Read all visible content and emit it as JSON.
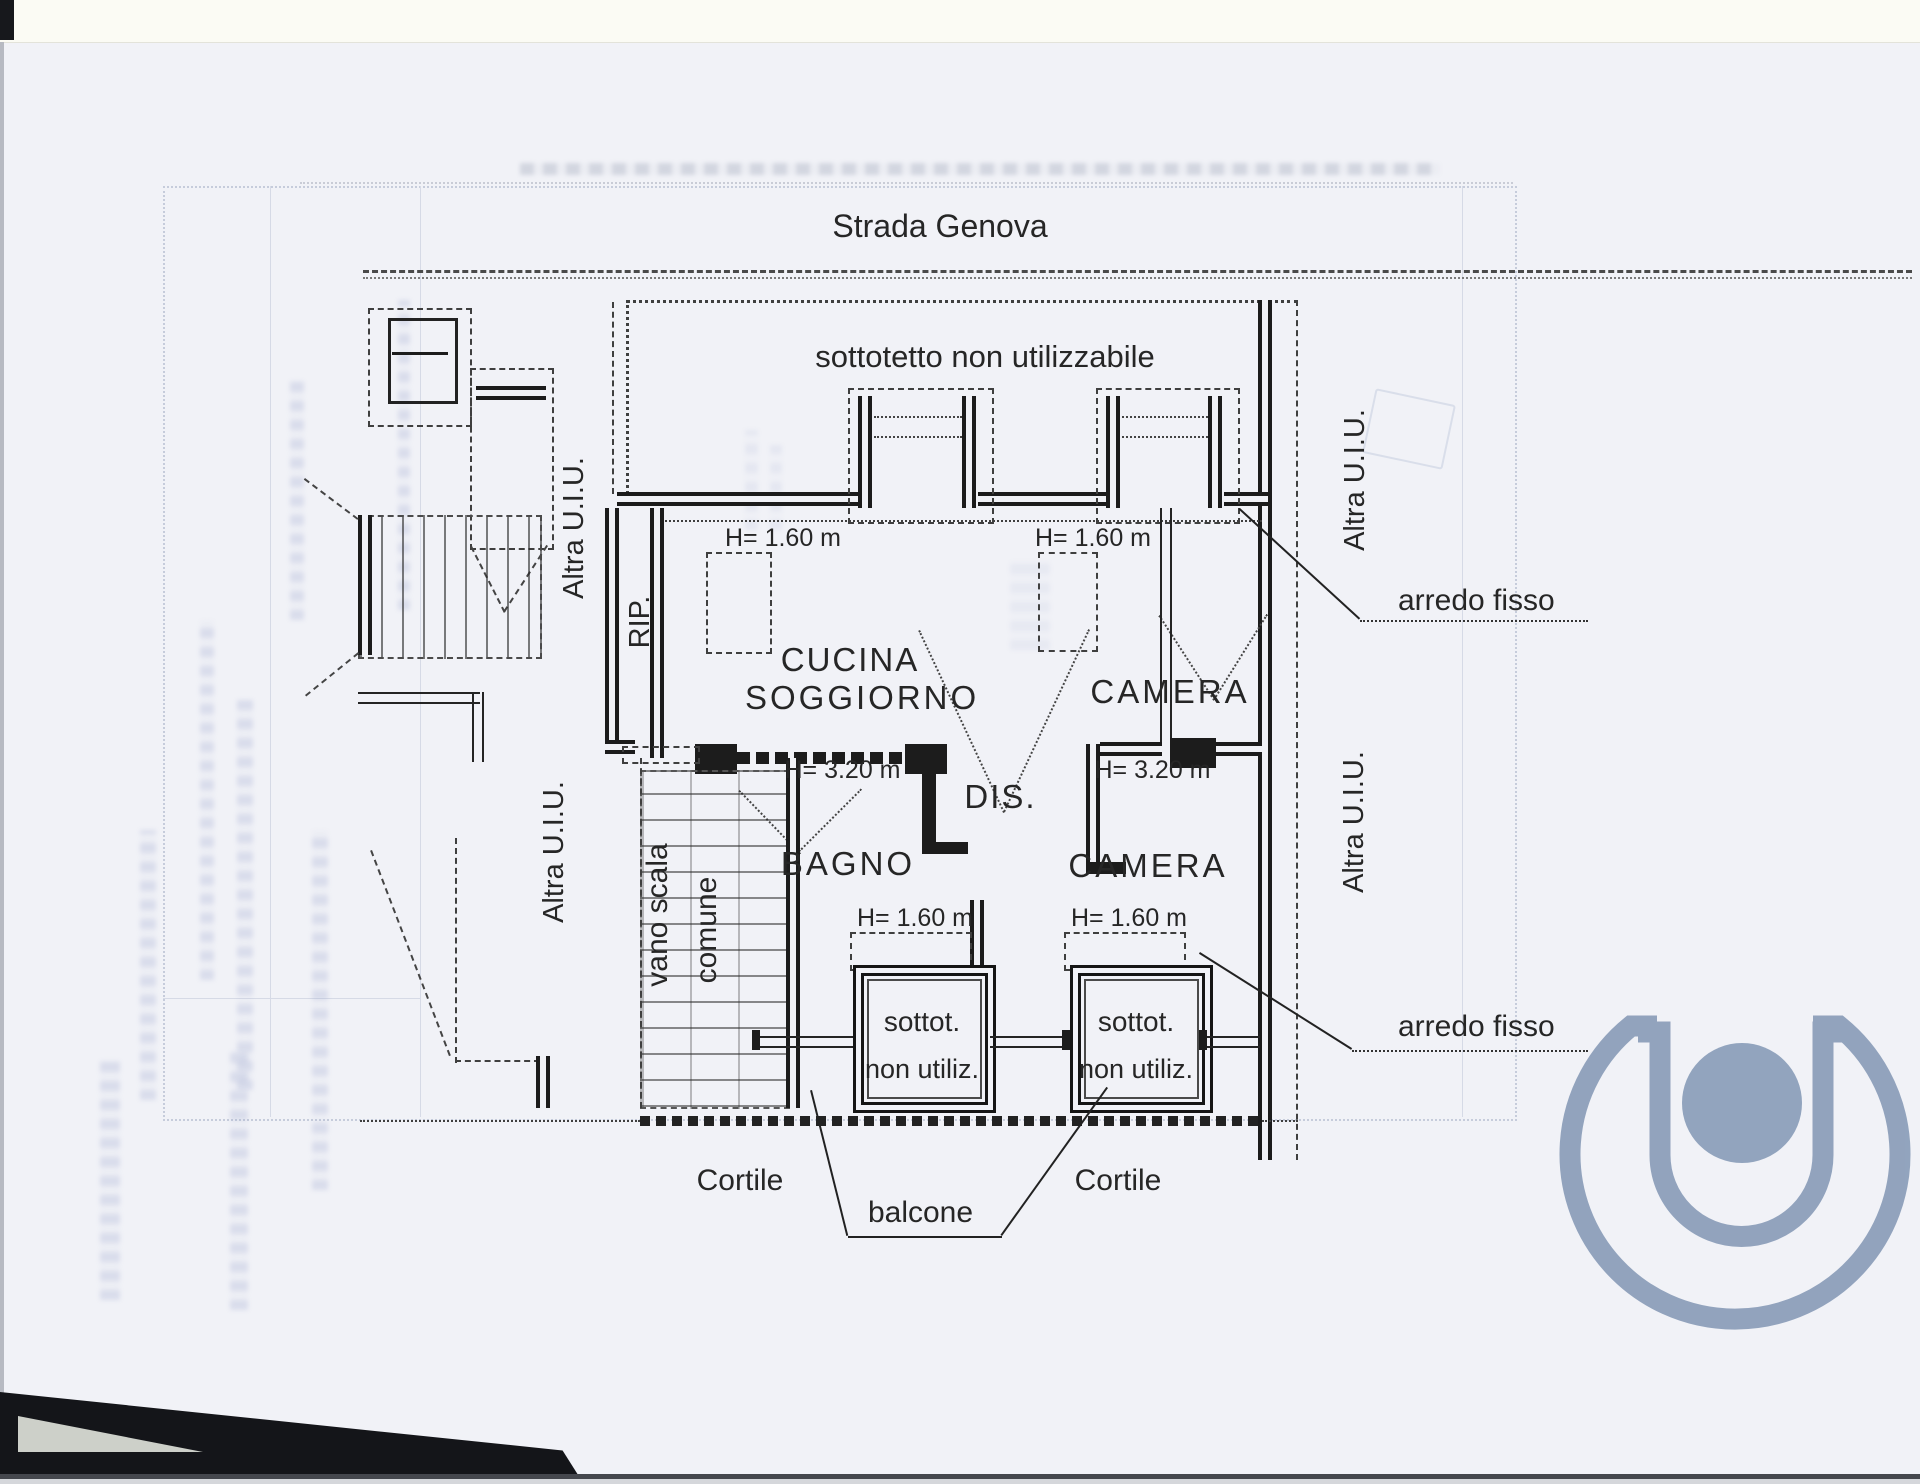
{
  "plan": {
    "street": "Strada Genova",
    "attic_note": "sottotetto non utilizzabile",
    "rooms": {
      "kitchen_line1": "CUCINA",
      "kitchen_line2": "SOGGIORNO",
      "bedroom": "CAMERA",
      "bathroom": "BAGNO",
      "hall": "DIS.",
      "closet": "RIP.",
      "stair_line1": "vano scala",
      "stair_line2": "comune"
    },
    "heights": {
      "low": "H= 1.60 m",
      "high": "H= 3.20 m"
    },
    "annotations": {
      "other_unit": "Altra U.I.U.",
      "fixed_furniture": "arredo fisso",
      "courtyard": "Cortile",
      "balcony": "balcone",
      "attic_abbr_line1": "sottot.",
      "attic_abbr_line2": "non utiliz."
    },
    "colors": {
      "ink": "#262626",
      "paper": "#f1f2f7",
      "watermark": "#8a9db9"
    }
  }
}
